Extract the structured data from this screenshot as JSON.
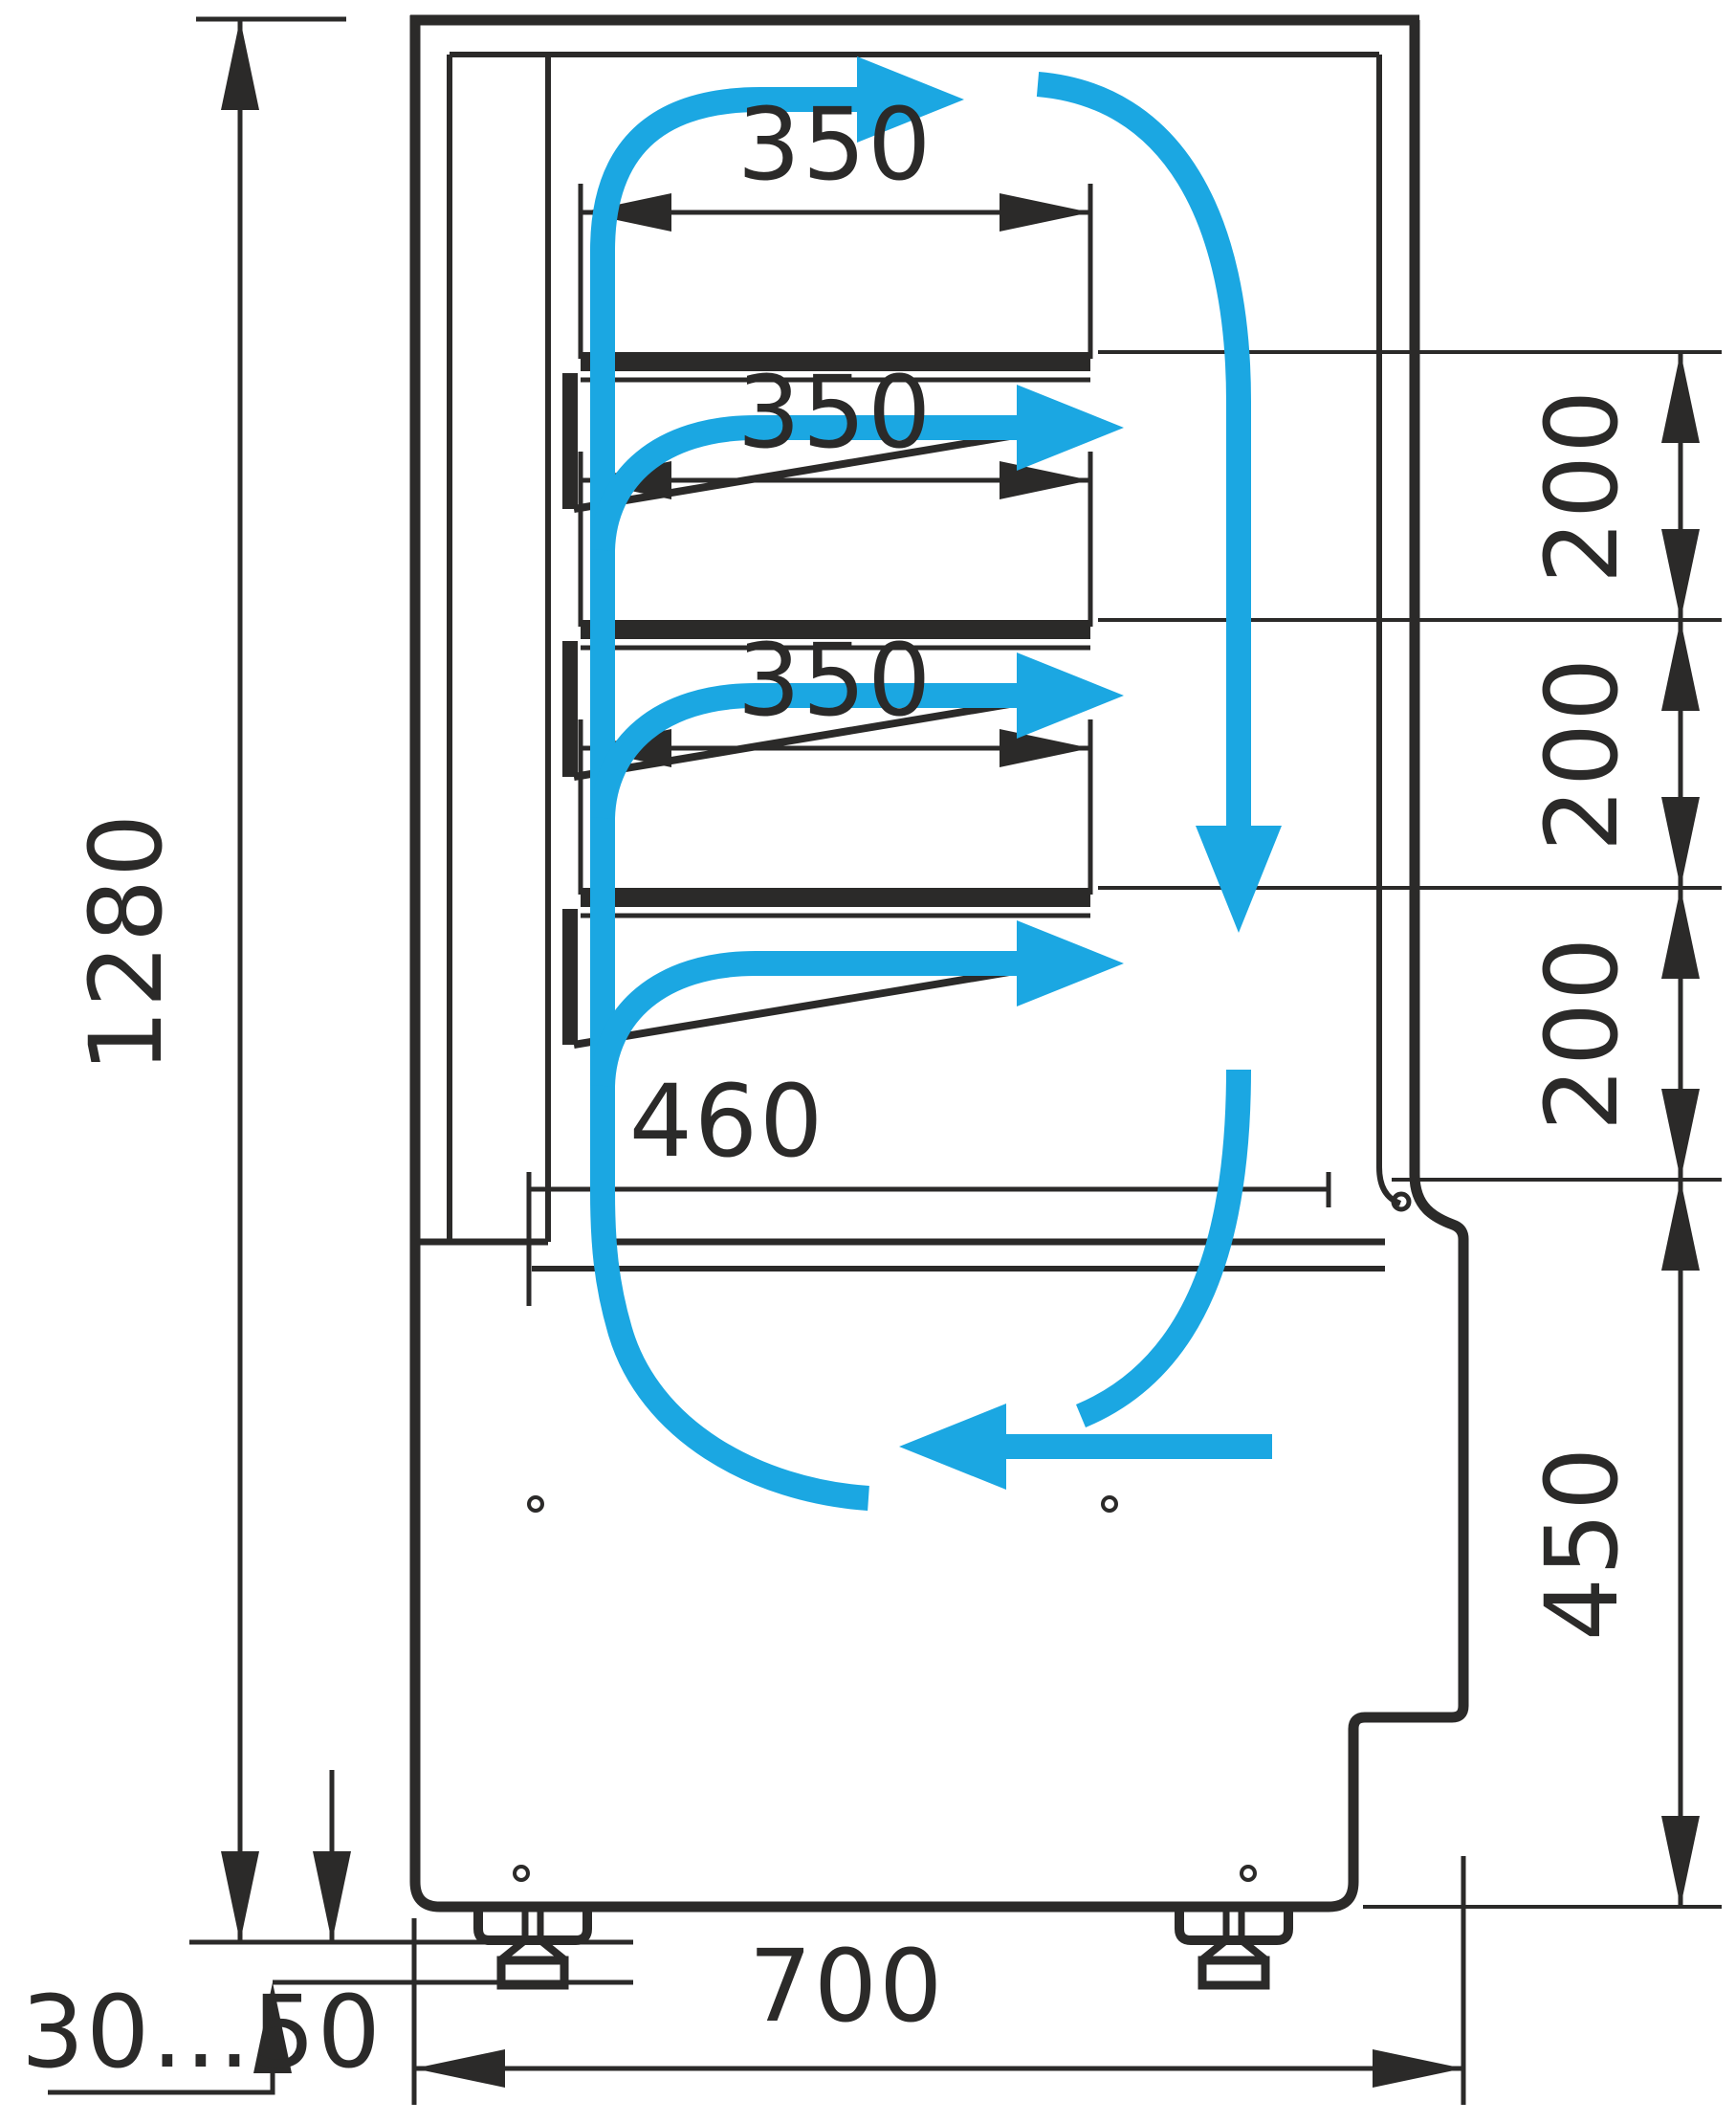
{
  "drawing": {
    "type": "refrigerated-display-case-side-section",
    "colors": {
      "line": "#2b2a29",
      "airflow": "#1ba7e2",
      "background": "#ffffff"
    },
    "dimensions": {
      "shelf_depth_labels": [
        "350",
        "350",
        "350"
      ],
      "bottom_shelf_depth": "460",
      "shelf_gap_labels": [
        "200",
        "200",
        "200"
      ],
      "overall_height": "1280",
      "base_height": "450",
      "overall_depth": "700",
      "feet_height_range": "30...50"
    }
  }
}
